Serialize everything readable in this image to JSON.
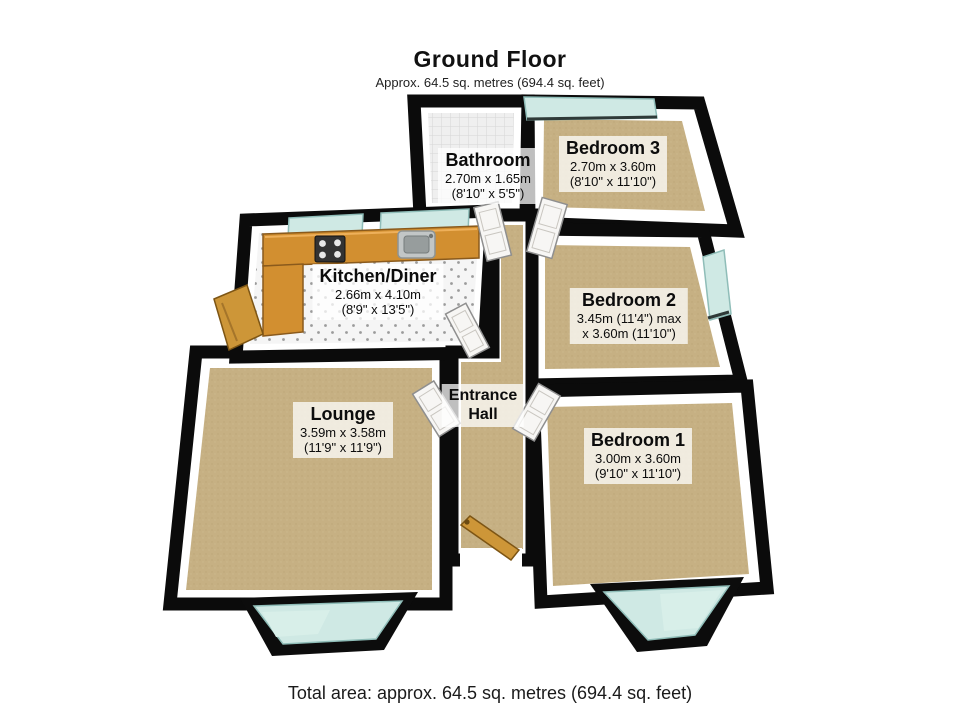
{
  "header": {
    "title": "Ground Floor",
    "subtitle": "Approx. 64.5 sq. metres (694.4 sq. feet)"
  },
  "footer": {
    "total_area": "Total area: approx. 64.5 sq. metres (694.4 sq. feet)"
  },
  "rooms": {
    "bathroom": {
      "name": "Bathroom",
      "metric": "2.70m x 1.65m",
      "imperial": "(8'10\" x 5'5\")"
    },
    "bedroom3": {
      "name": "Bedroom 3",
      "metric": "2.70m x 3.60m",
      "imperial": "(8'10\" x 11'10\")"
    },
    "kitchen": {
      "name": "Kitchen/Diner",
      "metric": "2.66m x 4.10m",
      "imperial": "(8'9\" x 13'5\")"
    },
    "bedroom2": {
      "name": "Bedroom 2",
      "metric": "3.45m (11'4\") max",
      "imperial": "x 3.60m (11'10\")"
    },
    "lounge": {
      "name": "Lounge",
      "metric": "3.59m x 3.58m",
      "imperial": "(11'9\" x 11'9\")"
    },
    "hall": {
      "line1": "Entrance",
      "line2": "Hall"
    },
    "bedroom1": {
      "name": "Bedroom 1",
      "metric": "3.00m x 3.60m",
      "imperial": "(9'10\" x 11'10\")"
    }
  },
  "colors": {
    "wall": "#0b0b0b",
    "wall_inner_face": "#ffffff",
    "carpet": "#c6b083",
    "bathroom_tile": "#efefef",
    "kitchen_tile": "#f5f5f5",
    "window_glass": "#cfe9e4",
    "counter_wood": "#d28f30",
    "door_wood": "#cd9638",
    "door_white": "#f7f6f4",
    "label_background": "rgba(255,255,255,0.74)",
    "text": "#0c0c0c"
  }
}
